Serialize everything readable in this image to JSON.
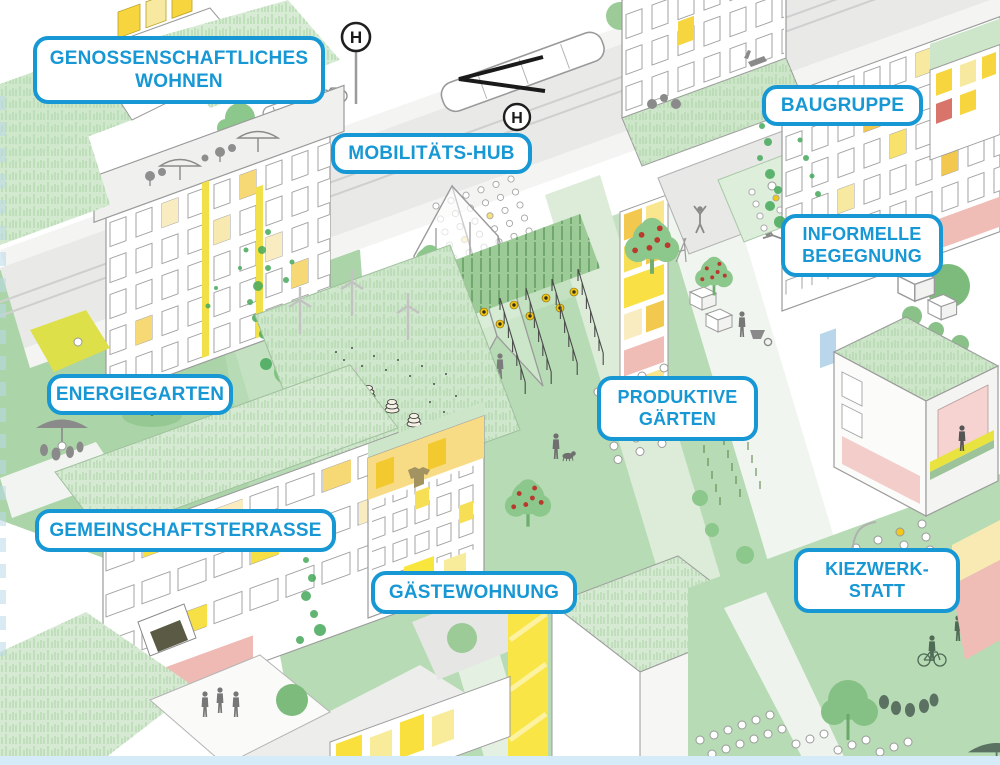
{
  "labels": [
    {
      "id": "genossenschaftliches-wohnen",
      "text": "GENOSSENSCHAFTLICHES\nWOHNEN"
    },
    {
      "id": "mobilitaets-hub",
      "text": "MOBILITÄTS-HUB"
    },
    {
      "id": "baugruppe",
      "text": "BAUGRUPPE"
    },
    {
      "id": "informelle-begegnung",
      "text": "INFORMELLE\nBEGEGNUNG"
    },
    {
      "id": "energiegarten",
      "text": "ENERGIEGARTEN"
    },
    {
      "id": "produktive-gaerten",
      "text": "PRODUKTIVE\nGÄRTEN"
    },
    {
      "id": "gemeinschaftsterrasse",
      "text": "GEMEINSCHAFTSTERRASSE"
    },
    {
      "id": "gaestewohnung",
      "text": "GÄSTEWOHNUNG"
    },
    {
      "id": "kiezwerkstatt",
      "text": "KIEZWERK-\nSTATT"
    }
  ],
  "signs": {
    "tram_stop_letter": "H"
  },
  "colors": {
    "label_blue": "#1798d5",
    "street_gray": "#e9e9e8",
    "sidewalk_gray": "#f4f4f2",
    "courtyard_green": "#b7dbb4",
    "roof_grass_green": "#d6ead3",
    "tree_green": "#8cc78c",
    "dark_tree_green": "#7dbb7d",
    "vine_green": "#46a95b",
    "accent_yellow": "#f8e045",
    "pale_yellow": "#f7ecb0",
    "accent_orange": "#f2c94e",
    "accent_pink": "#f0bcb6",
    "apple_red": "#b9392d",
    "figure_gray": "#8a8a8a",
    "silhouette_green": "#5b7263",
    "bottom_strip_blue": "#d6ebf8"
  }
}
